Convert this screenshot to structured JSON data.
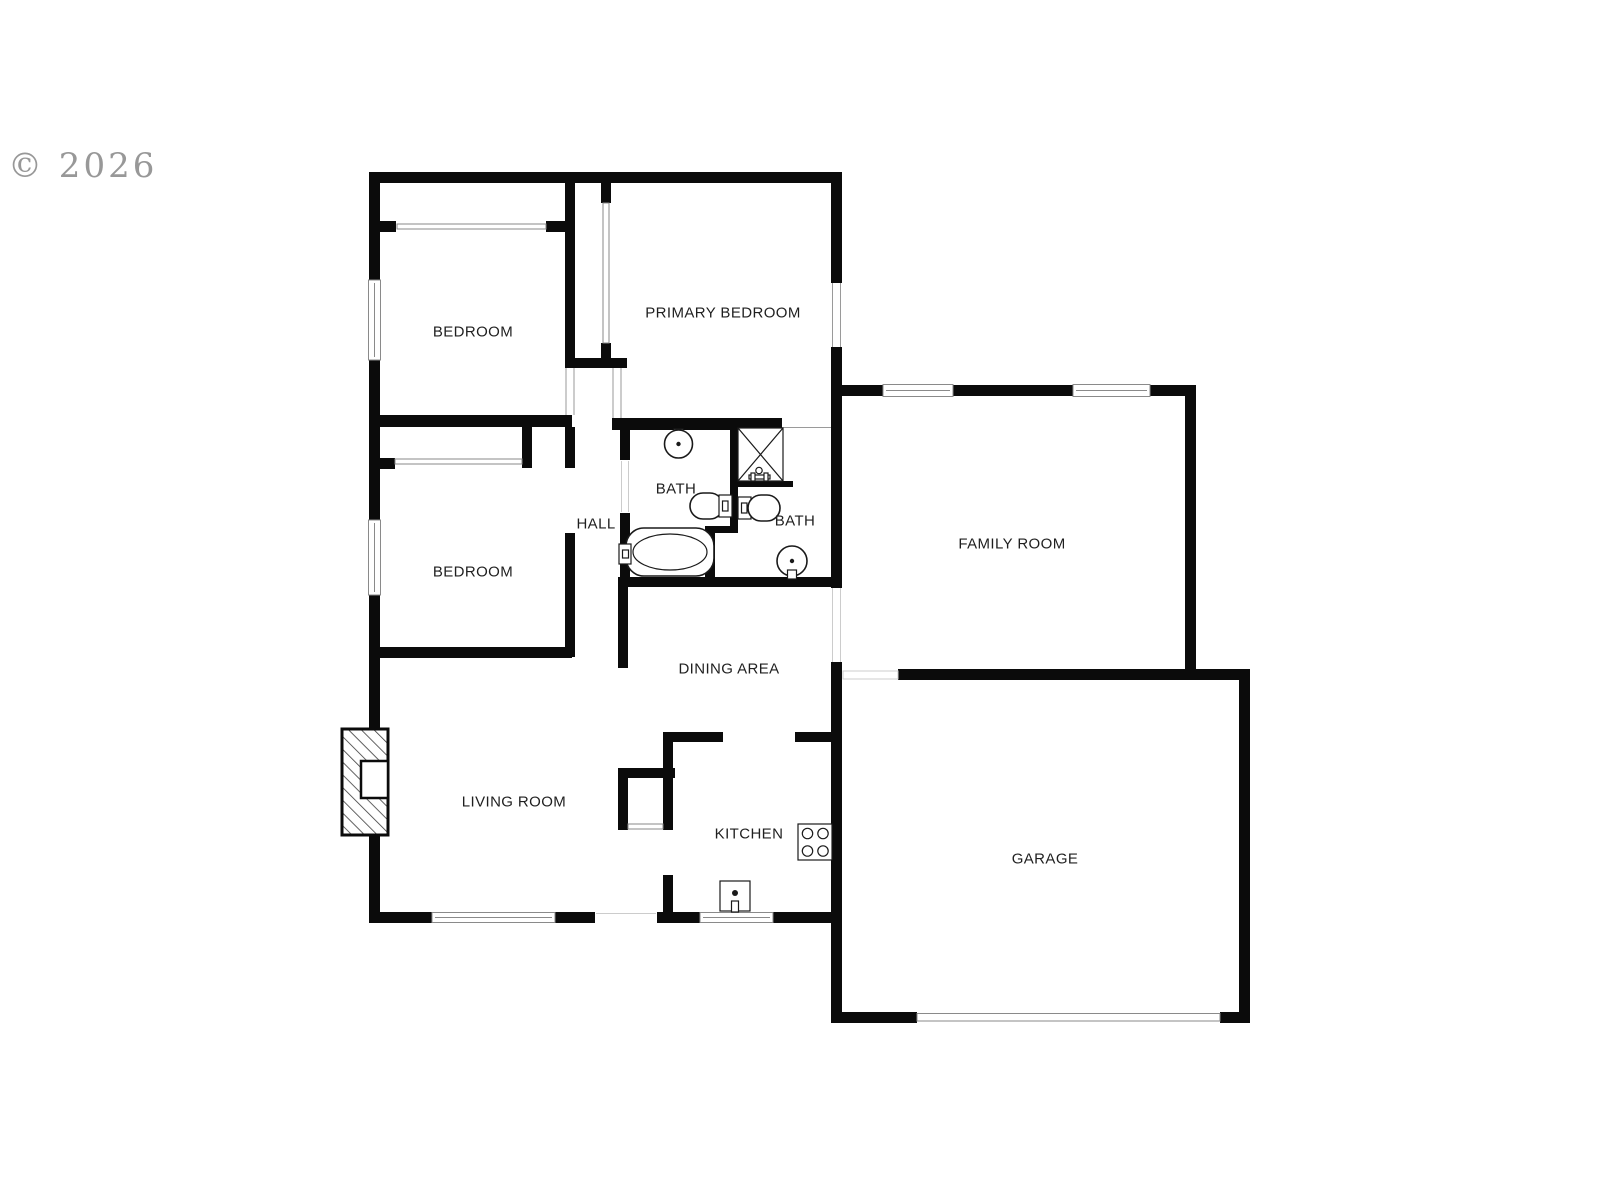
{
  "watermark": {
    "text": "© 2026",
    "color": "#8d8d8d"
  },
  "rooms": [
    {
      "id": "bedroom-1",
      "label": "BEDROOM"
    },
    {
      "id": "primary-bedroom",
      "label": "PRIMARY BEDROOM"
    },
    {
      "id": "bedroom-2",
      "label": "BEDROOM"
    },
    {
      "id": "hall",
      "label": "HALL"
    },
    {
      "id": "bath-1",
      "label": "BATH"
    },
    {
      "id": "bath-2",
      "label": "BATH"
    },
    {
      "id": "family-room",
      "label": "FAMILY ROOM"
    },
    {
      "id": "dining-area",
      "label": "DINING AREA"
    },
    {
      "id": "living-room",
      "label": "LIVING ROOM"
    },
    {
      "id": "kitchen",
      "label": "KITCHEN"
    },
    {
      "id": "garage",
      "label": "GARAGE"
    }
  ],
  "fixtures": [
    "pedestal-sink",
    "toilet",
    "bathtub",
    "shower",
    "pedestal-sink",
    "toilet",
    "stove-cooktop",
    "kitchen-sink",
    "fireplace"
  ],
  "colors": {
    "wall": "#0b0b0b",
    "label": "#1f1f1f",
    "watermark": "#8d8d8d",
    "opening_line": "#999999",
    "background": "#ffffff"
  }
}
